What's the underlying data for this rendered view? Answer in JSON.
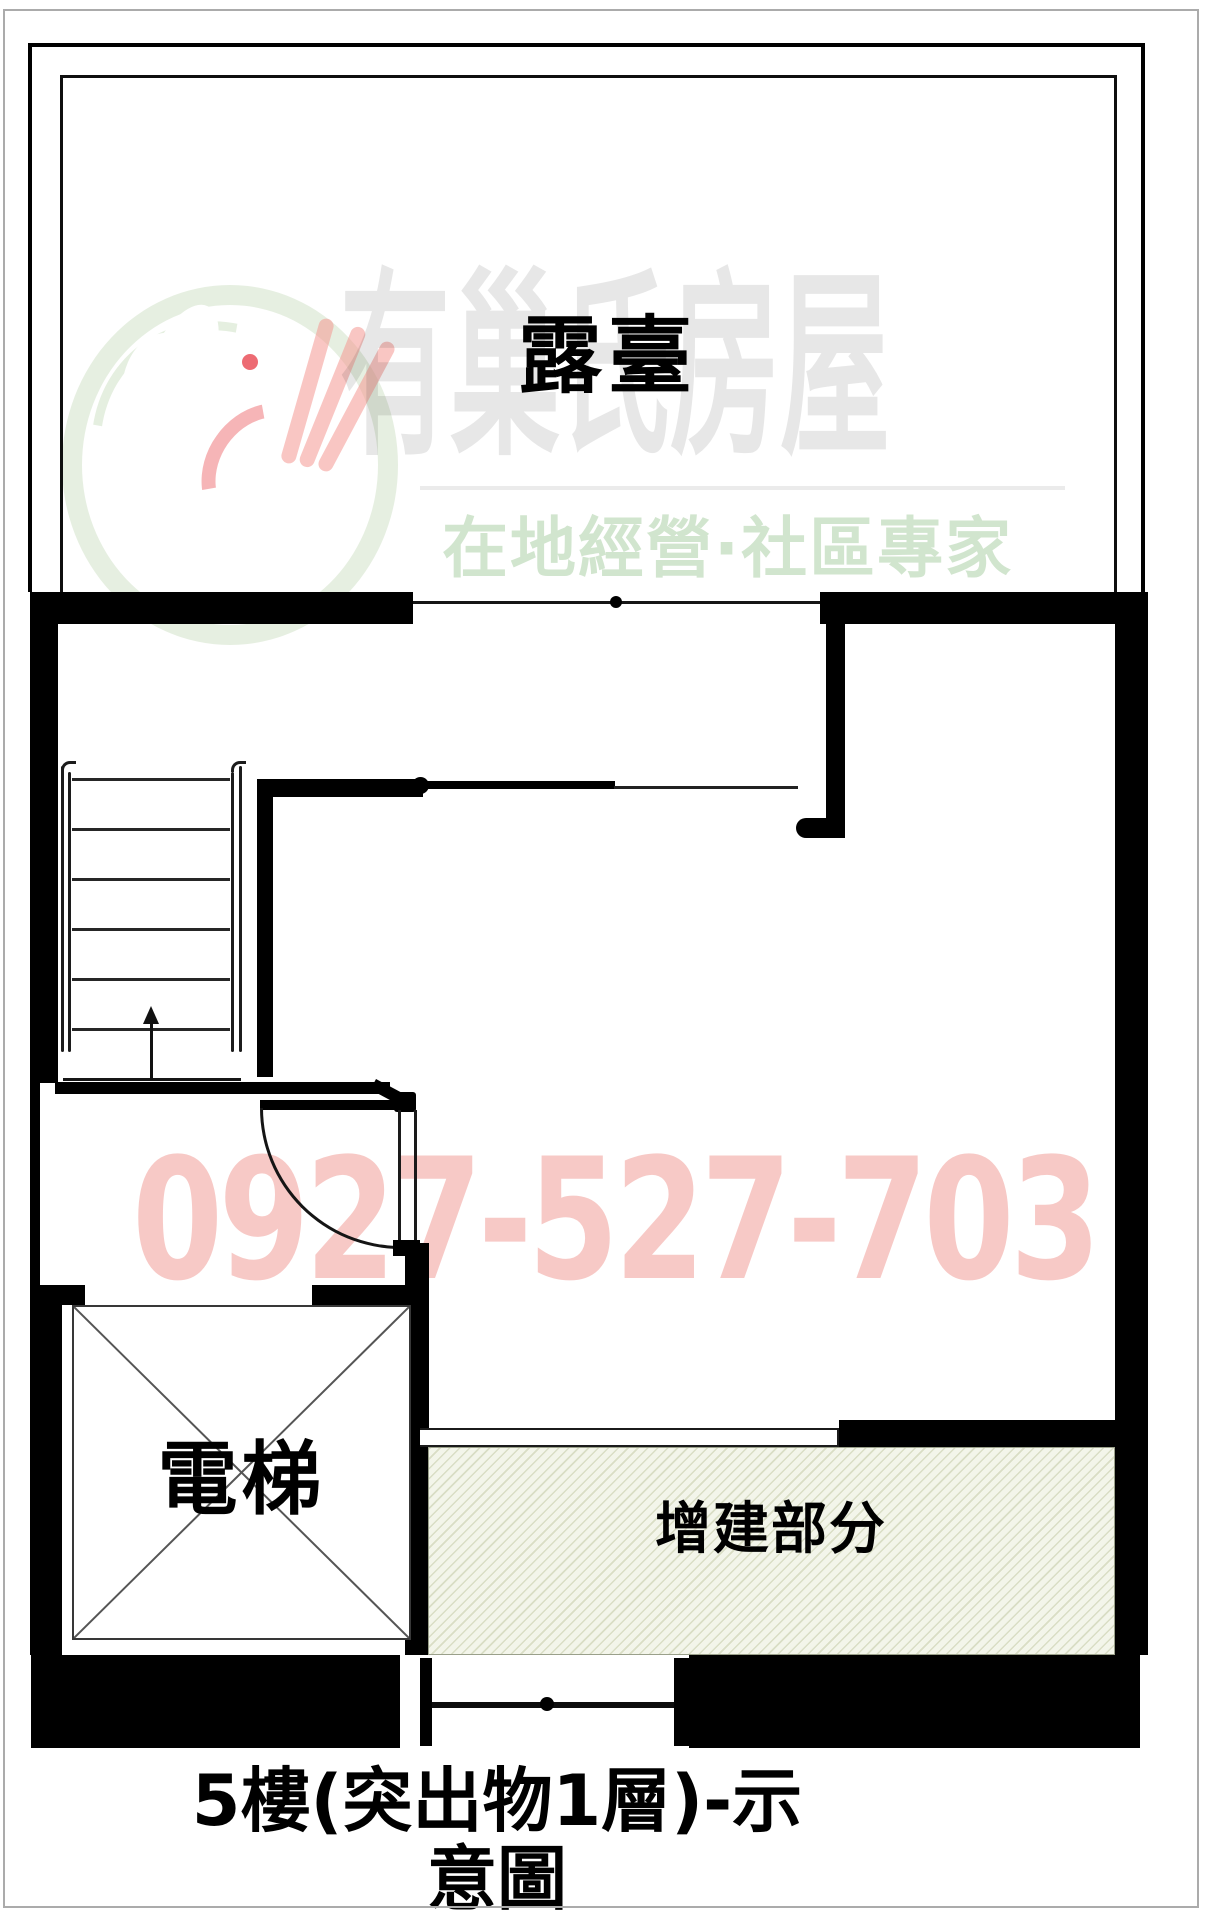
{
  "plan": {
    "labels": {
      "terrace": "露臺",
      "elevator": "電梯",
      "addition": "增建部分"
    },
    "title": {
      "line1": "5樓(突出物1層)-示",
      "line2": "意圖"
    }
  },
  "watermark": {
    "brand": "有巢氏房屋",
    "slogan": "在地經營·社區專家",
    "phone": "0927-527-703"
  },
  "colors": {
    "wall": "#000000",
    "hatch_background": "#f3f5ea",
    "hatch_stripe": "#b8c08c",
    "watermark_gray": "#e9e9e9",
    "watermark_green": "#d8e7d6",
    "watermark_pink": "#f6c9c3",
    "logo_red": "#e8505a",
    "logo_ring_green": "#cfe4c4",
    "logo_hand_pink": "#f5a9a3"
  }
}
